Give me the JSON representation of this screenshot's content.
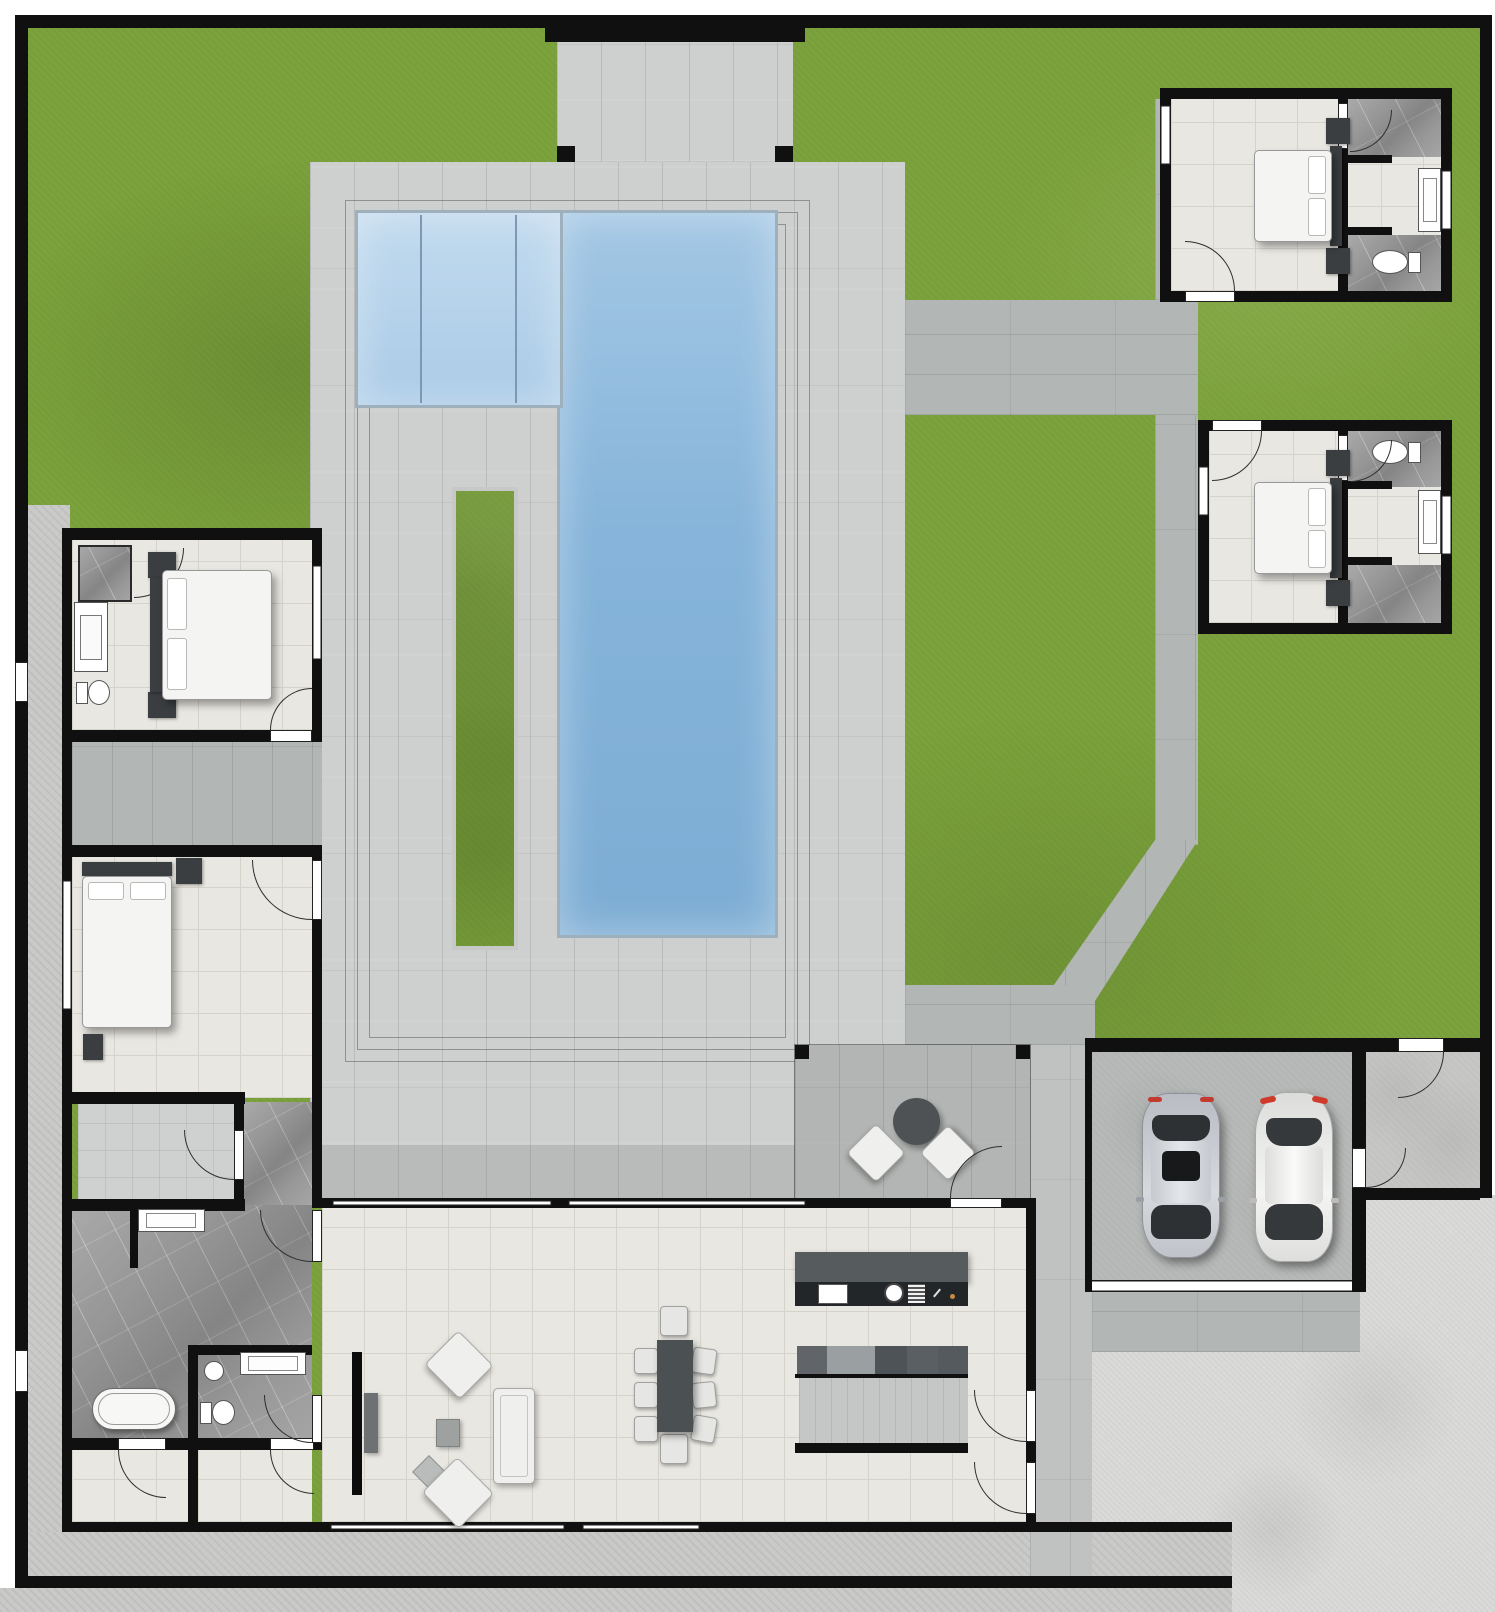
{
  "document": {
    "kind": "architectural floor plan / site plan rendering",
    "visible_text": []
  },
  "colors": {
    "wall": "#101010",
    "grass": "#7ba23c",
    "paver_light": "#cdd0ce",
    "paver_mid": "#b2b6b4",
    "paver_mid2": "#bfc2c0",
    "pool_edge": "#9db0bc",
    "tile": "#e9e7e1",
    "tile_line": "#d6d3ca",
    "marble": "#979797",
    "marble_light": "#cfd1d0",
    "sidewalk": "#c9cac8",
    "driveway": "#d9dad8",
    "garage_floor": "#b7b9b8",
    "storage_floor": "#c6c7c5",
    "furniture_dark": "#3a3e41",
    "sofa": "#efefed",
    "island_top": "#565b5e",
    "island_base": "#232628",
    "table": "#4b5053",
    "pantry_floor": "#c4c7c5",
    "car_silver": "#c7cbd1",
    "car_white": "#ebebe9",
    "counter_1": "#61656a",
    "counter_2": "#9aa0a2",
    "counter_3": "#4e5357",
    "counter_4": "#5a5f63",
    "counter_5": "#555a5e",
    "shade": "rgba(75,80,78,0.16)",
    "water_lane": "#7e98b4"
  },
  "regions": {
    "lawn": {
      "label": "Lawn"
    },
    "entry_porch": {
      "label": "Entry porch"
    },
    "courtyard": {
      "label": "Paved courtyard"
    },
    "pool": {
      "label": "Swimming pool"
    },
    "planter": {
      "label": "Grass planter strip"
    },
    "guest_suite_1": {
      "label": "Guest suite 1"
    },
    "guest_suite_2": {
      "label": "Guest suite 2"
    },
    "bedroom_1": {
      "label": "Bedroom 1"
    },
    "bedroom_2": {
      "label": "Bedroom 2"
    },
    "corridor": {
      "label": "Side corridor"
    },
    "closet": {
      "label": "Walk-in closet"
    },
    "master_bath": {
      "label": "Master bathroom"
    },
    "wc": {
      "label": "Toilet room"
    },
    "utility_1": {
      "label": "Utility room"
    },
    "utility_2": {
      "label": "Laundry room"
    },
    "living_room": {
      "label": "Living room"
    },
    "dining": {
      "label": "Dining area"
    },
    "kitchen": {
      "label": "Kitchen"
    },
    "pantry": {
      "label": "Pantry"
    },
    "patio": {
      "label": "Covered patio"
    },
    "garage": {
      "label": "Two-car garage"
    },
    "storage": {
      "label": "Storage / mudroom"
    },
    "driveway": {
      "label": "Driveway"
    },
    "walkway": {
      "label": "Garden walkway"
    },
    "sidewalk": {
      "label": "Perimeter sidewalk"
    }
  },
  "furniture": {
    "beds": 4,
    "toilets": 4,
    "bathtubs": 1,
    "showers": 3,
    "sinks": 6,
    "sofas": 3,
    "dining_chairs": 8,
    "dining_tables": 1,
    "outdoor_chairs": 2,
    "outdoor_tables": 1,
    "cars": 2,
    "tv": 1,
    "kitchen_islands": 1
  }
}
